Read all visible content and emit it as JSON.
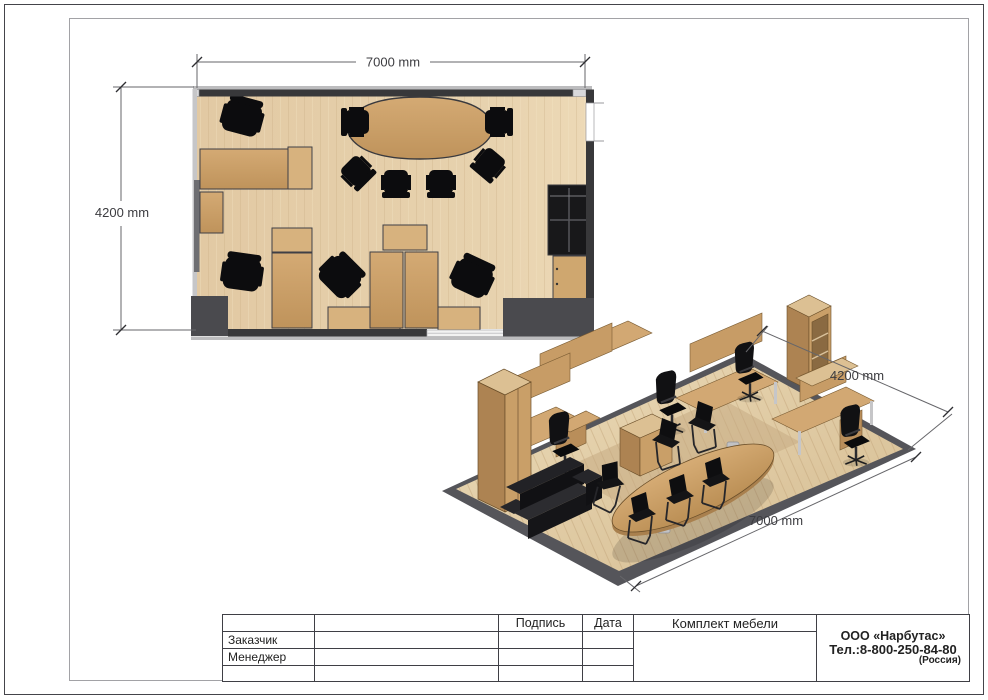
{
  "document": {
    "type": "furniture-layout-drawing",
    "project_title": "Комплект мебели"
  },
  "plan_view": {
    "width_dim_label": "7000 mm",
    "height_dim_label": "4200 mm"
  },
  "iso_view": {
    "depth_dim_label": "4200 mm",
    "width_dim_label": "7000 mm"
  },
  "title_block": {
    "col_signature": "Подпись",
    "col_date": "Дата",
    "row_customer": "Заказчик",
    "row_manager": "Менеджер",
    "project_title": "Комплект мебели",
    "company_name": "ООО «Нарбутас»",
    "company_phone": "Тел.:8-800-250-84-80",
    "company_country": "(Россия)"
  },
  "colors": {
    "desk_wood": "#c79b61",
    "cabinet_wood_light": "#d7b27e",
    "floor_wood": "#e4cda8",
    "wall_dark": "#38383a",
    "wall_block": "#4a4a4e",
    "wall_light": "#bcbcbe",
    "black_furniture": "#0c0c0e",
    "dimension_line": "#66666a",
    "frame_border": "#a2a2a6",
    "page_border": "#44444a"
  }
}
